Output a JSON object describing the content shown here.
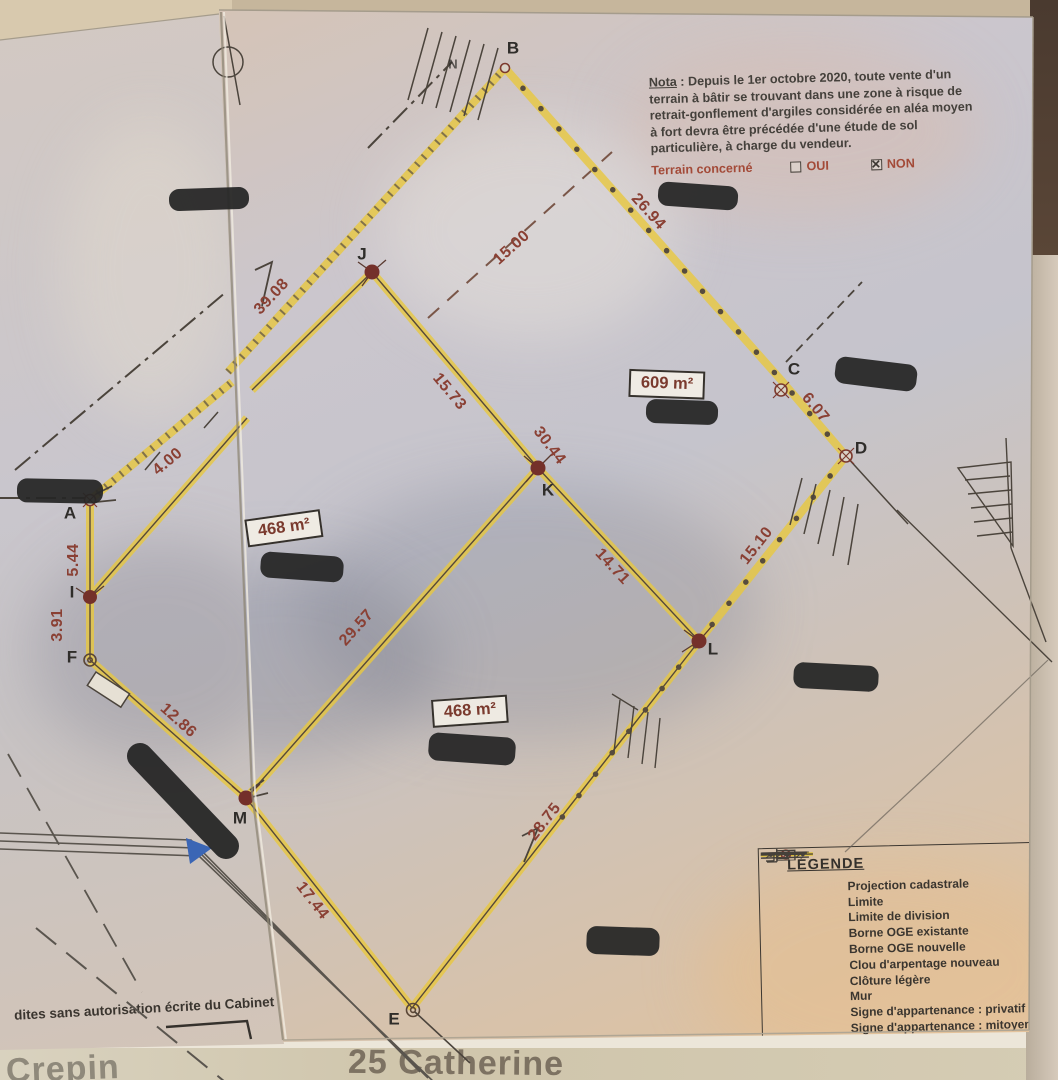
{
  "colors": {
    "division_yellow": "#e8c83f",
    "measure_red": "#8a4034",
    "borne_red": "#74302a",
    "paper_ink": "#46403a"
  },
  "plan": {
    "points": {
      "a": "A",
      "b": "B",
      "c": "C",
      "d": "D",
      "e": "E",
      "f": "F",
      "i": "I",
      "j": "J",
      "k": "K",
      "l": "L",
      "m": "M",
      "n": "N"
    },
    "areas": {
      "p609": "609 m²",
      "p468a": "468 m²",
      "p468b": "468 m²"
    },
    "dims": {
      "ab": "39.08",
      "bc": "26.94",
      "div": "15.00",
      "cd": "6.07",
      "jk": "15.73",
      "k30": "30.44",
      "kl": "14.71",
      "ld": "15.10",
      "a4": "4.00",
      "ai": "5.44",
      "if": "3.91",
      "fm": "12.86",
      "km": "29.57",
      "me": "17.44",
      "el": "28.75"
    }
  },
  "nota": {
    "label": "Nota",
    "body": " : Depuis le 1er octobre 2020, toute vente d'un terrain à bâtir se trouvant dans une zone à risque de retrait-gonflement d'argiles considérée en aléa moyen à fort devra être précédée d'une étude de sol particulière, à charge du vendeur.",
    "terrain": "Terrain concerné",
    "oui": "OUI",
    "non": "NON",
    "oui_checked": false,
    "non_checked": true
  },
  "legend": {
    "title": "LÉGENDE",
    "items": [
      {
        "label": "Projection cadastrale"
      },
      {
        "label": "Limite"
      },
      {
        "label": "Limite de division"
      },
      {
        "label": "Borne OGE existante"
      },
      {
        "label": "Borne OGE nouvelle"
      },
      {
        "label": "Clou d'arpentage nouveau"
      },
      {
        "label": "Clôture légère"
      },
      {
        "label": "Mur"
      },
      {
        "label": "Signe d'appartenance : privatif"
      },
      {
        "label": "Signe d'appartenance : mitoyen"
      },
      {
        "label": "Bâtiment"
      }
    ]
  },
  "footer": {
    "copyright": "dites sans autorisation écrite du Cabinet",
    "underlay_left": "Crepin",
    "underlay_bottom": "25 Catherine"
  }
}
